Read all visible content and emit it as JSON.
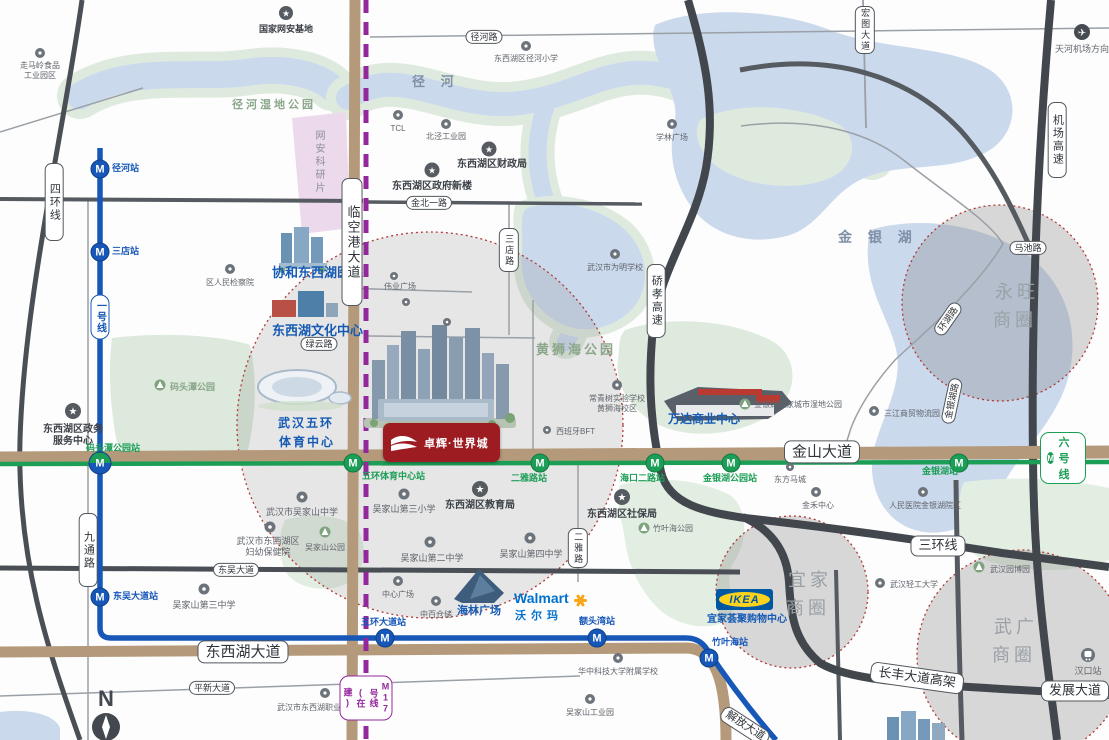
{
  "icons": {
    "star": "★",
    "plane": "✈",
    "n": "N",
    "m": "M"
  },
  "areas": {
    "jinghe_river": "径 河",
    "jinyin_lake": "金 银 湖",
    "huangshihai_park": "黄狮海公园",
    "jinghe_wetland_park": "径河湿地公园",
    "wangan_research_zone": "网安科研片",
    "matoutan_park": "码头潭公园"
  },
  "circles": {
    "yongwang": {
      "line1": "永旺",
      "line2": "商圈"
    },
    "ikea": {
      "line1": "宜家",
      "line2": "商圈"
    },
    "wuguang": {
      "line1": "武广",
      "line2": "商圈"
    }
  },
  "road_signs": {
    "sihuanxian": "四环线",
    "linkonggang_dadao": "临空港大道",
    "jichang_gaosu": "机场高速",
    "qiaoxiao_gaosu": "硚孝高速",
    "jiutong_lu": "九通路",
    "sandian_lu": "三店路",
    "erya_lu": "二雅路",
    "hongtu_dadao": "宏图大道",
    "jinghe_lu": "径河路",
    "jinbei_yilu": "金北一路",
    "lvyun_lu": "绿云路",
    "machi_lu": "马池路",
    "huanhu_lu": "环湖路",
    "jinyinhu_lu": "金银湖路",
    "jinshan_dadao": "金山大道",
    "sanhuanxian": "三环线",
    "dongwu_dadao": "东吴大道",
    "dongxihu_dadao": "东西湖大道",
    "pingxin_dadao": "平新大道",
    "changfeng_gaojia": "长丰大道高架",
    "fazhan_dadao": "发展大道",
    "jiefang_dadao": "解放大道"
  },
  "metro": {
    "m": "M",
    "line1_badge": "一号线",
    "line6_badge": "六号线",
    "line17_badge": "17号线(在建)",
    "stations": {
      "jinghe": "径河站",
      "sandian": "三店站",
      "matoutan": "码头潭公园站",
      "dongwu": "东吴大道站",
      "wuhuan_dadao": "五环大道站",
      "etouwan": "额头湾站",
      "zhuyehai": "竹叶海站",
      "wuhuan_tiyu": "五环体育中心站",
      "erya": "二雅路站",
      "haikou": "海口二路站",
      "jinyinhu_gongyuan": "金银湖公园站",
      "jinyinhu": "金银湖站"
    }
  },
  "landmarks": {
    "xiehe_hospital": "协和东西湖医院",
    "culture_center": "东西湖文化中心",
    "sports_center_1": "武汉五环",
    "sports_center_2": "体育中心",
    "wanda": "万达商业中心",
    "hailin": "海林广场",
    "ikea_mall": "宜家荟聚购物中心"
  },
  "logos": {
    "project": "卓辉·世界城",
    "walmart_en": "Walmart",
    "walmart_cn": "沃尔玛",
    "ikea": "IKEA"
  },
  "pois": {
    "zoumaling1": "走马岭食品",
    "zoumaling2": "工业园区",
    "wangan_base": "国家网安基地",
    "jinghe_primary": "东西湖区径河小学",
    "beijing_industry": "北泾工业园",
    "tcl": "TCL",
    "caizhengju": "东西湖区财政局",
    "zhengfu_xinlou": "东西湖区政府新楼",
    "xuelin": "学林广场",
    "weiming_school": "武汉市为明学校",
    "jianchayuan": "区人民检察院",
    "changqing1": "常青树实验学校",
    "changqing2": "黄狮海校区",
    "spain_bft": "西班牙BFT",
    "shidi_park": "金银湖国家城市湿地公园",
    "sanjiang": "三江商贸物流园",
    "dongfang_macheng": "东方马城",
    "tianhe_airport": "天河机场方向",
    "zhengwu1": "东西湖区政务",
    "zhengwu2": "服务中心",
    "wujiashan_middle": "武汉市吴家山中学",
    "fuyou1": "武汉市东西湖区",
    "fuyou2": "妇幼保健院",
    "wujiashan_park": "吴家山公园",
    "no3_primary": "吴家山第三小学",
    "jiaoyuju": "东西湖区教育局",
    "no2_middle": "吴家山第二中学",
    "no4_middle": "吴家山第四中学",
    "shebaoju": "东西湖区社保局",
    "zhuyehai_park": "竹叶海公园",
    "no3_middle": "吴家山第三中学",
    "zhongxin_plaza": "中心广场",
    "zhongbai": "中百仓储",
    "zhiye_school": "武汉市东西湖职业技术学校",
    "huazhong_school": "华中科技大学附属学校",
    "wujiashan_industry": "吴家山工业园",
    "qinggong_univ": "武汉轻工大学",
    "renmin_hospital": "人民医院金银湖院区",
    "jinhe_center": "金禾中心",
    "yuanboyuan": "武汉园博园",
    "hankou_station": "汉口站",
    "weiye_plaza": "伟业广场"
  },
  "colors": {
    "metro_line1": "#1657b8",
    "metro_line6": "#1d9e57",
    "metro_line17": "#93279c",
    "landmark_blue": "#155ab4",
    "project_red": "#9c1c22",
    "walmart_blue": "#0071ce",
    "ikea_blue": "#0058a3",
    "ikea_yellow": "#fcd21c",
    "road_tan": "#b49a7a",
    "road_dark": "#4a4f55",
    "circle_border_red": "#b03a35"
  }
}
